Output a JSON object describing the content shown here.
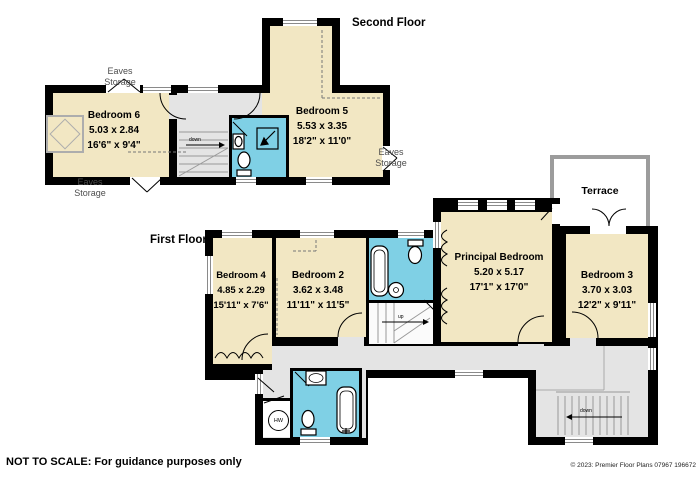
{
  "meta": {
    "floor2_label": "Second Floor",
    "floor1_label": "First Floor",
    "footer_note": "NOT TO SCALE: For guidance purposes only",
    "copyright": "© 2023: Premier Floor Plans 07967 196672"
  },
  "colors": {
    "wall": "#000000",
    "room_fill": "#F2E7C3",
    "bathroom_fill": "#7FD0E5",
    "hall_fill": "#E4E4E4",
    "terrace_border": "#9C9C9C",
    "eaves_text": "#4D4D4D"
  },
  "rooms": {
    "bedroom6": {
      "name": "Bedroom 6",
      "metric": "5.03 x 2.84",
      "imperial": "16'6\" x 9'4\""
    },
    "bedroom5": {
      "name": "Bedroom 5",
      "metric": "5.53 x 3.35",
      "imperial": "18'2\" x 11'0\""
    },
    "bedroom4": {
      "name": "Bedroom 4",
      "metric": "4.85 x 2.29",
      "imperial": "15'11\" x 7'6\""
    },
    "bedroom2": {
      "name": "Bedroom 2",
      "metric": "3.62 x 3.48",
      "imperial": "11'11\" x 11'5\""
    },
    "principal": {
      "name": "Principal Bedroom",
      "metric": "5.20 x 5.17",
      "imperial": "17'1\" x 17'0\""
    },
    "bedroom3": {
      "name": "Bedroom 3",
      "metric": "3.70 x 3.03",
      "imperial": "12'2\" x 9'11\""
    },
    "terrace": {
      "name": "Terrace"
    }
  },
  "labels": {
    "eaves": {
      "line1": "Eaves",
      "line2": "Storage"
    },
    "stairs_down": "down",
    "stairs_up": "up",
    "hot_water": "HW"
  }
}
